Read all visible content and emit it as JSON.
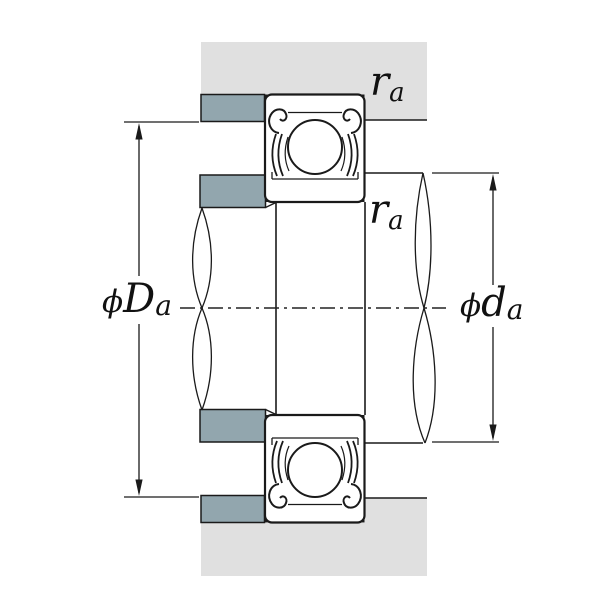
{
  "title": "Bearing mounting dimensions cross-section",
  "diagram": {
    "description": "Cross-section of a shielded deep-groove ball bearing mounted between shaft and housing, showing abutment shoulder diameters and fillet radii",
    "labels": {
      "housing_shoulder": {
        "phi": "ϕ",
        "letter": "D",
        "sub": "a"
      },
      "shaft_shoulder": {
        "phi": "ϕ",
        "letter": "d",
        "sub": "a"
      },
      "fillet_top": {
        "letter": "r",
        "sub": "a"
      },
      "fillet_mid": {
        "letter": "r",
        "sub": "a"
      }
    },
    "colors": {
      "housing_fill": "#e0e0e0",
      "shoulder_fill": "#92a6ae",
      "line": "#1a1a1a",
      "background": "#ffffff"
    }
  }
}
